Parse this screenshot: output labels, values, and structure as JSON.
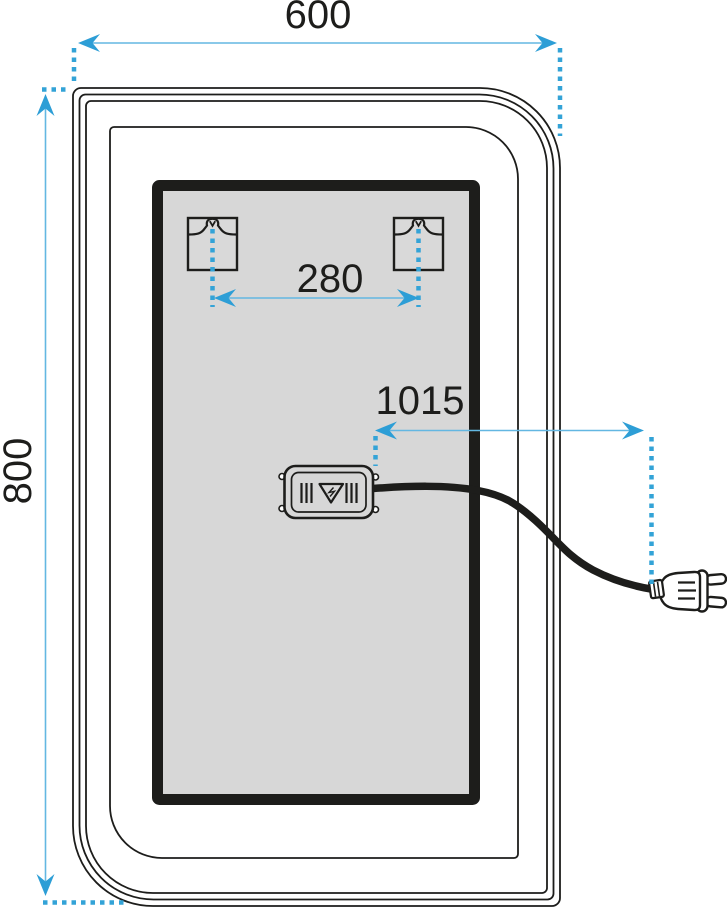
{
  "drawing": {
    "title": "Mirror technical dimension drawing (rear view)",
    "dimensions": {
      "width_mm": "600",
      "height_mm": "800",
      "bracket_spacing_mm": "280",
      "cable_length_mm": "1015"
    },
    "components": {
      "mounting_brackets": 2,
      "junction_box": "driver box with vent slots and warning triangle",
      "power_plug": "two-pin europlug on cable"
    },
    "colors": {
      "accent_blue": "#33a3d7",
      "dim_line_blue": "#63b7e2",
      "outline_black": "#1d1d1b",
      "panel_gray": "#d7d7d7"
    }
  }
}
